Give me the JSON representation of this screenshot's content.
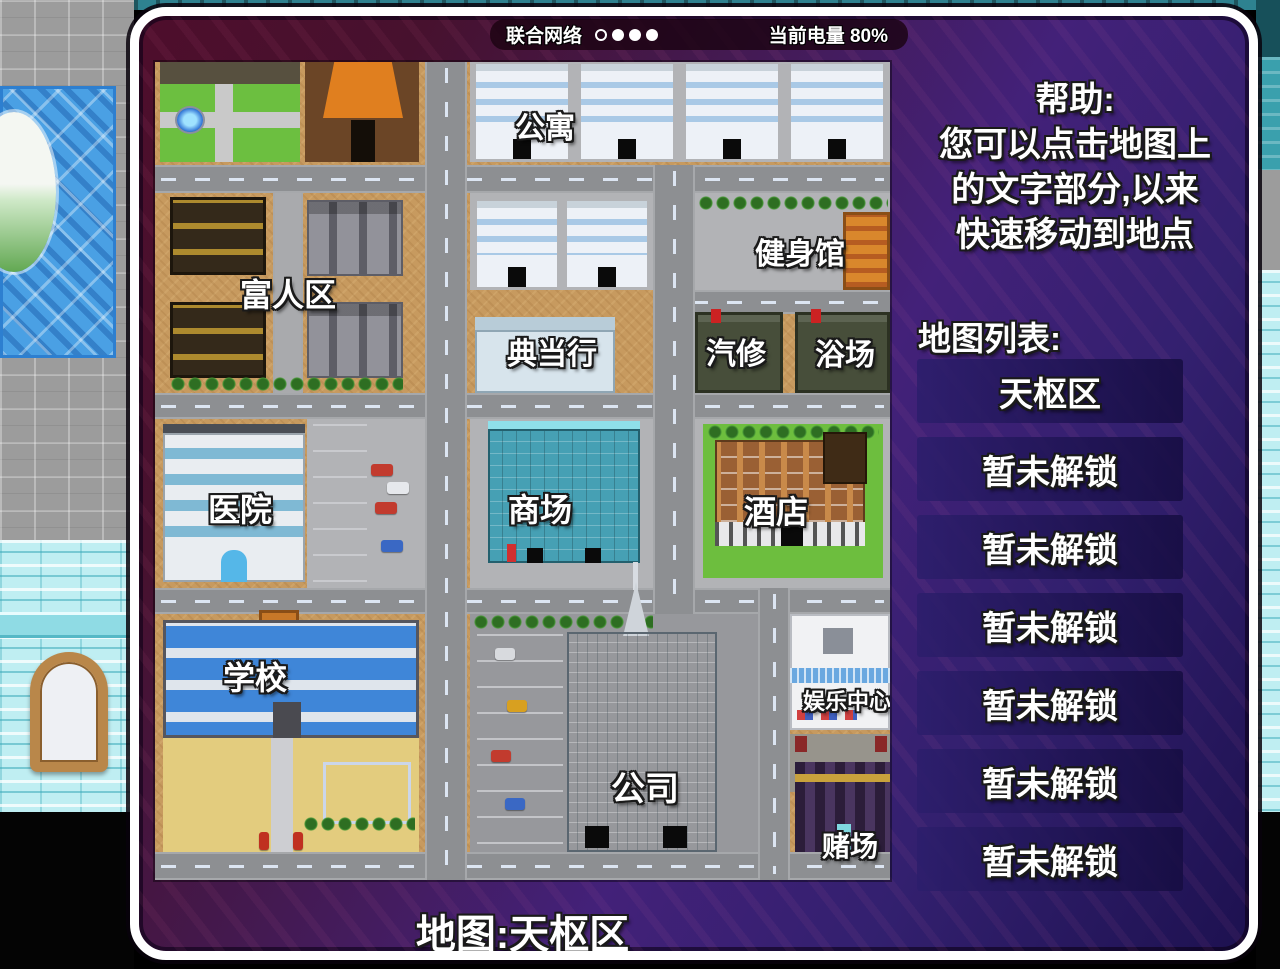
{
  "status_bar": {
    "network": "联合网络",
    "battery": "当前电量 80%",
    "signal_icon": "signal-dots-1-hollow-3-filled"
  },
  "help": {
    "title": "帮助:",
    "line1": "您可以点击地图上",
    "line2": "的文字部分,以来",
    "line3": "快速移动到地点"
  },
  "map_list": {
    "title": "地图列表:",
    "items": [
      {
        "label": "天枢区",
        "unlocked": true
      },
      {
        "label": "暂未解锁",
        "unlocked": false
      },
      {
        "label": "暂未解锁",
        "unlocked": false
      },
      {
        "label": "暂未解锁",
        "unlocked": false
      },
      {
        "label": "暂未解锁",
        "unlocked": false
      },
      {
        "label": "暂未解锁",
        "unlocked": false
      },
      {
        "label": "暂未解锁",
        "unlocked": false
      }
    ]
  },
  "map": {
    "footer": "地图:天枢区",
    "locations": [
      {
        "label": "公寓"
      },
      {
        "label": "健身馆"
      },
      {
        "label": "富人区"
      },
      {
        "label": "典当行"
      },
      {
        "label": "汽修"
      },
      {
        "label": "浴场"
      },
      {
        "label": "医院"
      },
      {
        "label": "商场"
      },
      {
        "label": "酒店"
      },
      {
        "label": "学校"
      },
      {
        "label": "娱乐中心"
      },
      {
        "label": "公司"
      },
      {
        "label": "赌场"
      }
    ]
  },
  "colors": {
    "panel_border": "#ffffff",
    "panel_purple": "#432179",
    "panel_maroon": "#4e0e2c",
    "button_bg": "#221a58",
    "map_sand": "#c79a5f",
    "road_grey": "#8d8f92",
    "text": "#ffffff"
  }
}
